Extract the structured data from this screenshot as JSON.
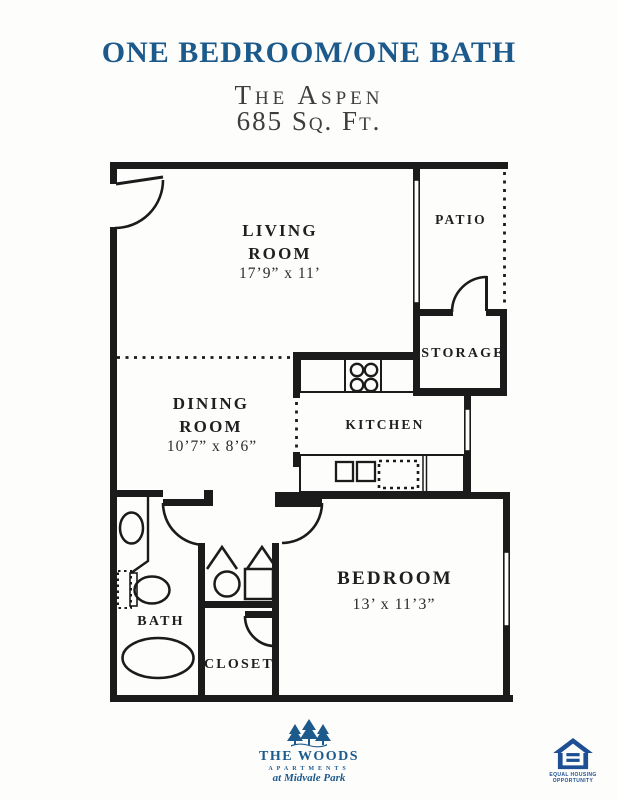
{
  "header": {
    "title": "ONE BEDROOM/ONE BATH",
    "plan_name": "The Aspen",
    "area": "685 Sq. Ft."
  },
  "floorplan": {
    "rooms": {
      "living": {
        "name_line1": "LIVING",
        "name_line2": "ROOM",
        "dims": "17’9” x 11’"
      },
      "dining": {
        "name_line1": "DINING",
        "name_line2": "ROOM",
        "dims": "10’7” x 8’6”"
      },
      "kitchen": {
        "name": "KITCHEN"
      },
      "patio": {
        "name": "PATIO"
      },
      "storage": {
        "name": "STORAGE"
      },
      "bedroom": {
        "name": "BEDROOM",
        "dims": "13’ x 11’3”"
      },
      "bath": {
        "name": "BATH"
      },
      "closet": {
        "name": "CLOSET"
      }
    },
    "fixture_icons": [
      "stove-burners",
      "kitchen-double-sink",
      "dishwasher",
      "toilet",
      "bathroom-sink",
      "bathtub",
      "water-heater",
      "hvac-unit"
    ],
    "feature_icons": [
      "entry-door",
      "patio-sliding-door",
      "storage-door",
      "bath-door",
      "bedroom-door",
      "closet-door",
      "bifold-utility-doors",
      "kitchen-window",
      "bedroom-window",
      "patio-edge-dotted",
      "room-divider-dotted"
    ]
  },
  "footer": {
    "brand": {
      "name": "THE WOODS",
      "subtitle": "APARTMENTS",
      "tagline": "at Midvale Park"
    },
    "equal_housing": {
      "line1": "EQUAL HOUSING",
      "line2": "OPPORTUNITY"
    }
  },
  "colors": {
    "accent": "#1c5a8c",
    "wall": "#1b1b1b",
    "eho-blue": "#1e4f94",
    "text-dark": "#2b2b2b"
  }
}
